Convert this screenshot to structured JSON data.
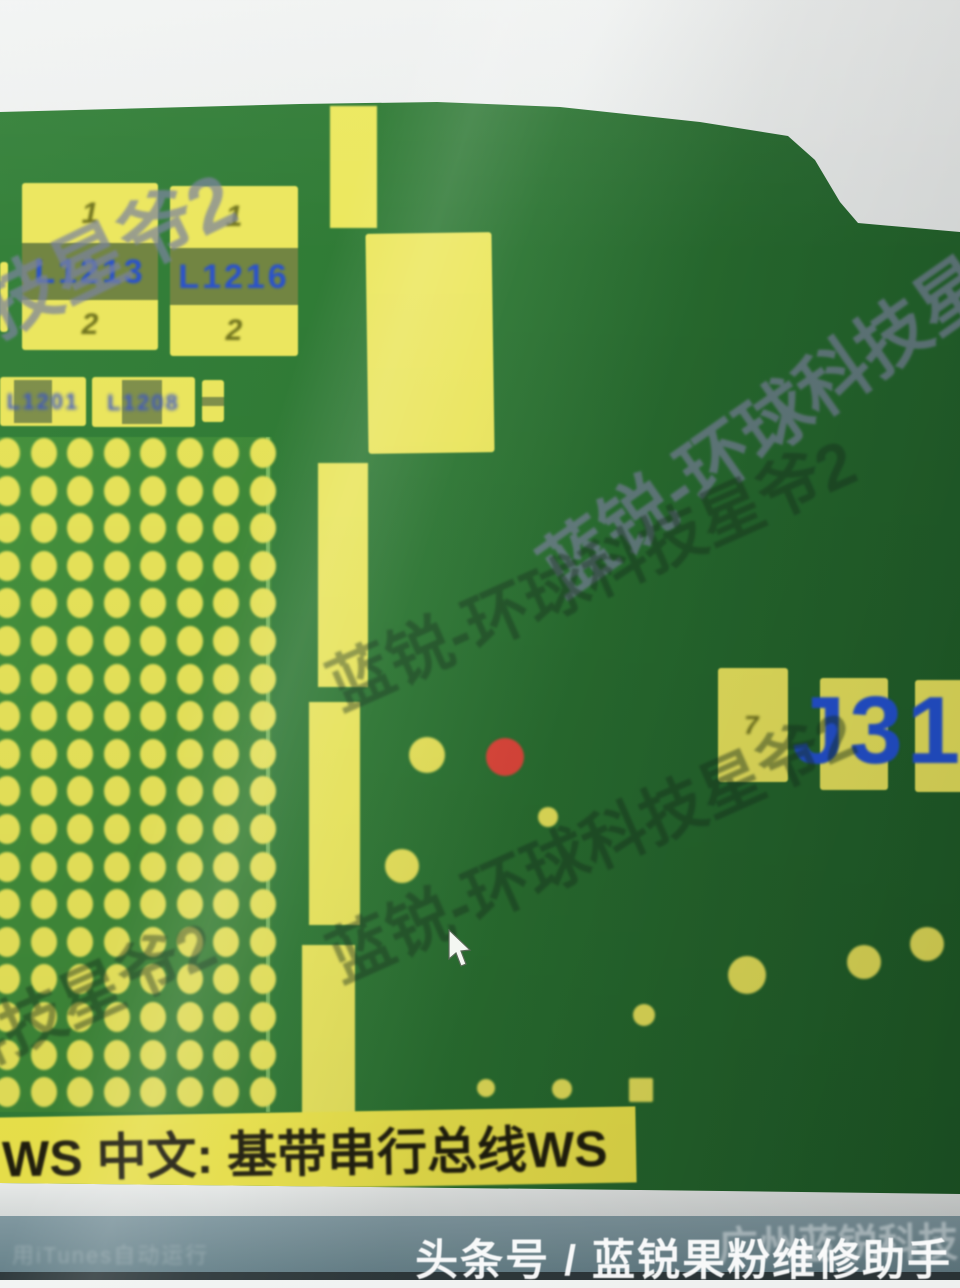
{
  "app": {
    "tooltip_text": "WS 中文: 基带串行总线WS",
    "status_text": "用iTunes自动运行",
    "watermark_text": "蓝锐-环球科技星爷2",
    "footer_text": "头条号 / 蓝锐果粉维修助手",
    "footer_overlay_text": "广州蓝锐科技"
  },
  "pcb": {
    "colors": {
      "board_green": "#2f7a35",
      "pad_yellow": "#ece75c",
      "silkscreen_blue": "#2a52cc",
      "highlight_red": "#e0463a",
      "pin_olive": "#70741f"
    },
    "components": [
      {
        "label": "L1213",
        "pin_top": "1",
        "pin_bottom": "2"
      },
      {
        "label": "L1216",
        "pin_top": "1",
        "pin_bottom": "2"
      }
    ],
    "small_components": [
      {
        "label": "L1201"
      },
      {
        "label": "L1208"
      }
    ],
    "connector": {
      "label": "J310",
      "pin_label": "7"
    },
    "bga_grid": {
      "cols": 8,
      "rows": 18,
      "x0": 7,
      "y0": 453,
      "dx": 36.5,
      "dy": 37.6,
      "rx": 13,
      "ry": 15
    },
    "bar_segments": [
      {
        "x": 330,
        "y": 106,
        "w": 47,
        "h": 122
      },
      {
        "x": 318,
        "y": 463,
        "w": 50,
        "h": 224
      },
      {
        "x": 309,
        "y": 702,
        "w": 51,
        "h": 223
      },
      {
        "x": 302,
        "y": 945,
        "w": 53,
        "h": 172
      }
    ],
    "big_pad_block": {
      "x": 367,
      "y": 233,
      "w": 126,
      "h": 220
    },
    "left_sliver": {
      "x": 0,
      "y": 262,
      "w": 8,
      "h": 70
    },
    "test_points": [
      {
        "x": 427,
        "y": 755,
        "r": 18,
        "color": "yellow"
      },
      {
        "x": 505,
        "y": 757,
        "r": 19,
        "color": "red"
      },
      {
        "x": 548,
        "y": 817,
        "r": 10,
        "color": "yellow"
      },
      {
        "x": 402,
        "y": 866,
        "r": 17,
        "color": "yellow"
      },
      {
        "x": 486,
        "y": 1088,
        "r": 9,
        "color": "yellow"
      },
      {
        "x": 562,
        "y": 1089,
        "r": 10,
        "color": "yellow"
      },
      {
        "x": 644,
        "y": 1015,
        "r": 11,
        "color": "yellow"
      },
      {
        "x": 641,
        "y": 1090,
        "r": 12,
        "color": "yellow",
        "shape": "square"
      },
      {
        "x": 747,
        "y": 975,
        "r": 19,
        "color": "yellow"
      },
      {
        "x": 864,
        "y": 962,
        "r": 17,
        "color": "yellow"
      },
      {
        "x": 927,
        "y": 944,
        "r": 17,
        "color": "yellow"
      }
    ],
    "watermark_instances": [
      {
        "x": -380,
        "y": 430,
        "angle": -26,
        "size": 76,
        "variant": "white"
      },
      {
        "x": 545,
        "y": 520,
        "angle": -35,
        "size": 72,
        "variant": "white"
      },
      {
        "x": 330,
        "y": 640,
        "angle": -24,
        "size": 64,
        "variant": "green"
      },
      {
        "x": 330,
        "y": 912,
        "angle": -24,
        "size": 64,
        "variant": "green"
      },
      {
        "x": -310,
        "y": 1122,
        "angle": -24,
        "size": 64,
        "variant": "green"
      }
    ]
  }
}
